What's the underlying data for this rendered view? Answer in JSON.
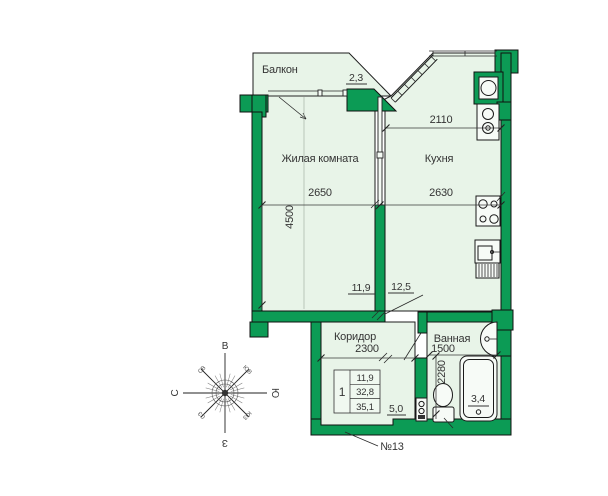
{
  "colors": {
    "wall": "#0c9b55",
    "room": "#e8f4e8",
    "line": "#1a1a1a"
  },
  "rooms": {
    "balcony": {
      "label": "Балкон",
      "area": "2,3"
    },
    "living_room": {
      "label": "Жилая комната",
      "area": "11,9",
      "width": "2650",
      "depth": "4500"
    },
    "kitchen": {
      "label": "Кухня",
      "area": "12,5",
      "width": "2630",
      "top_width": "2110"
    },
    "corridor": {
      "label": "Коридор",
      "area": "5,0",
      "width": "2300"
    },
    "bathroom": {
      "label": "Ванная",
      "area": "3,4",
      "width": "1500",
      "depth": "2280"
    }
  },
  "info_table": {
    "rooms_count": "1",
    "living_area": "11,9",
    "area": "32,8",
    "total_area": "35,1"
  },
  "apartment_number": "№13",
  "compass": {
    "top": "В",
    "right": "Ю",
    "bottom": "З",
    "left": "С",
    "top_left": "СВ",
    "top_right": "ЮВ",
    "bottom_left": "СЗ",
    "bottom_right": "ЮЗ"
  }
}
